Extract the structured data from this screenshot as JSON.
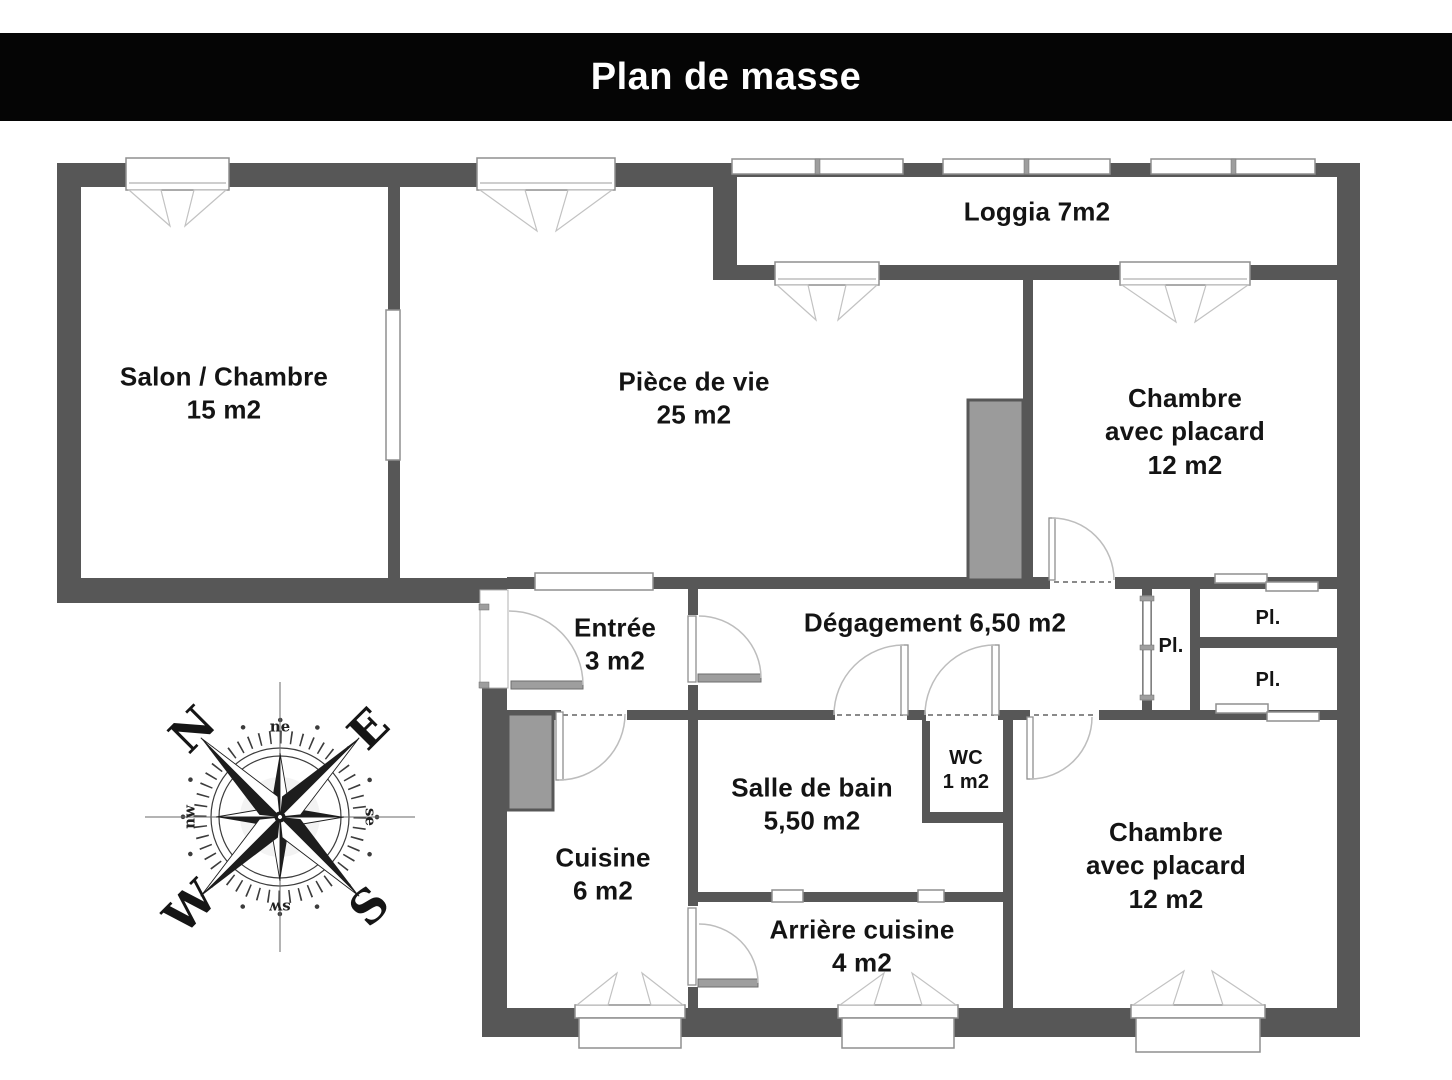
{
  "title_bar": {
    "text": "Plan de masse"
  },
  "rooms": {
    "salon": {
      "lines": [
        "Salon / Chambre",
        "15 m2"
      ]
    },
    "piece_de_vie": {
      "lines": [
        "Pièce de vie",
        "25 m2"
      ]
    },
    "loggia": {
      "lines": [
        "Loggia 7m2"
      ]
    },
    "chambre_nord": {
      "lines": [
        "Chambre",
        "avec placard",
        "12 m2"
      ]
    },
    "entree": {
      "lines": [
        "Entrée",
        "3 m2"
      ]
    },
    "degagement": {
      "lines": [
        "Dégagement 6,50 m2"
      ]
    },
    "placard_couloir": {
      "lines": [
        "Pl."
      ]
    },
    "placard_haut": {
      "lines": [
        "Pl."
      ]
    },
    "placard_bas": {
      "lines": [
        "Pl."
      ]
    },
    "cuisine": {
      "lines": [
        "Cuisine",
        "6 m2"
      ]
    },
    "salle_de_bain": {
      "lines": [
        "Salle de bain",
        "5,50 m2"
      ]
    },
    "wc": {
      "lines": [
        "WC",
        "1 m2"
      ]
    },
    "arriere_cuisine": {
      "lines": [
        "Arrière cuisine",
        "4 m2"
      ]
    },
    "chambre_sud": {
      "lines": [
        "Chambre",
        "avec placard",
        "12 m2"
      ]
    }
  },
  "compass": {
    "n": "N",
    "e": "E",
    "s": "S",
    "w": "W",
    "ne": "ne",
    "se": "se",
    "sw": "sw",
    "nw": "nw"
  },
  "colors": {
    "wall": "#575757",
    "duct": "#9b9b9b",
    "title_bg": "#050505",
    "title_text": "#ffffff",
    "label_text": "#141414"
  }
}
